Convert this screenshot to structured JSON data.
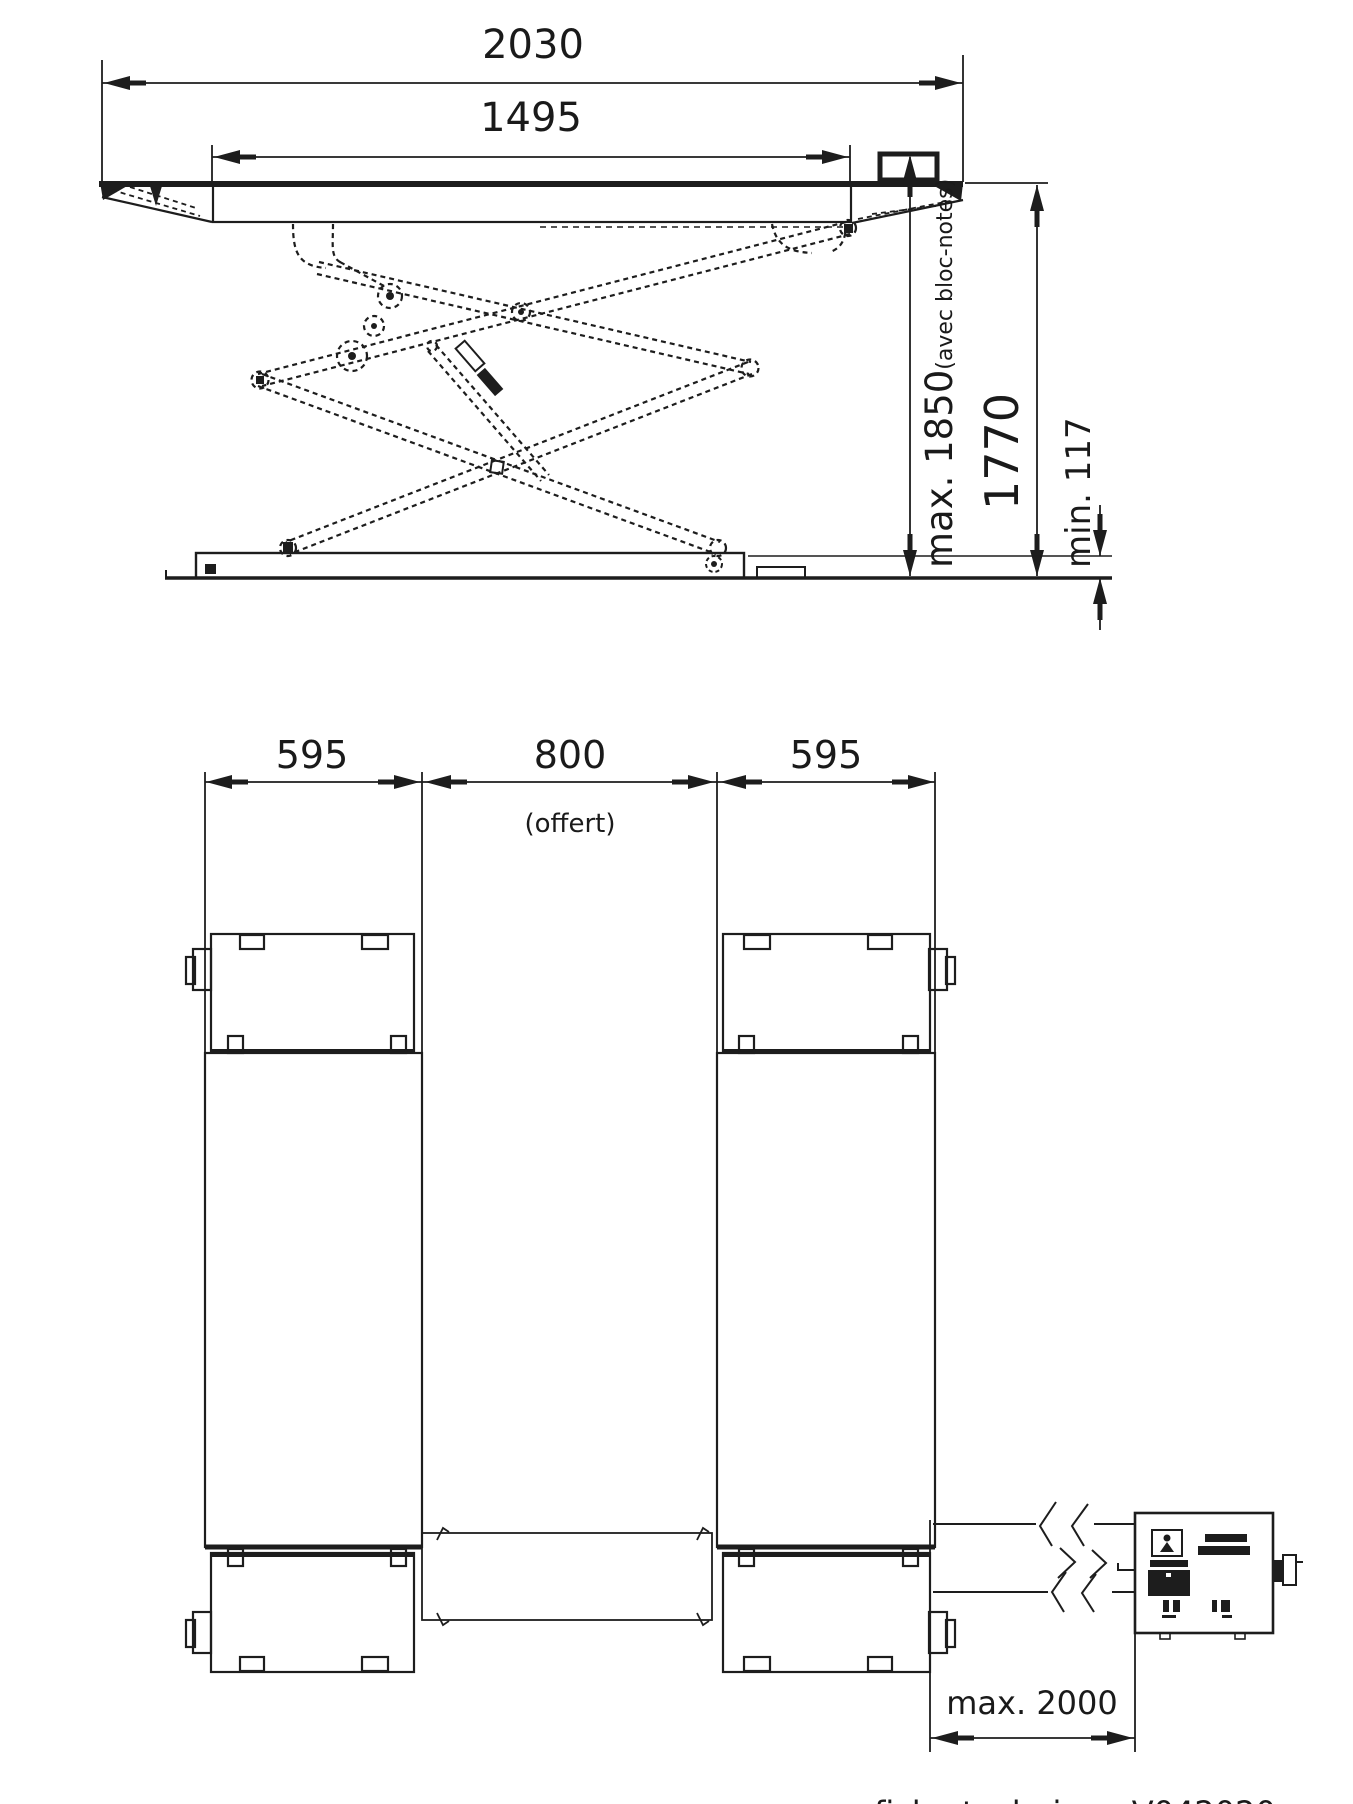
{
  "side_view": {
    "overall_width": "2030",
    "platform_length": "1495",
    "max_height": "max. 1850",
    "max_height_note": "(avec bloc-notes)",
    "lift_height": "1770",
    "min_height": "min. 117"
  },
  "plan_view": {
    "left_runway_width": "595",
    "center_gap": "800",
    "center_gap_note": "(offert)",
    "right_runway_width": "595",
    "cable_length": "max. 2000"
  },
  "footer": {
    "caption": "fiche technique V042020"
  },
  "colors": {
    "line": "#1d1d1d",
    "background": "#ffffff"
  }
}
